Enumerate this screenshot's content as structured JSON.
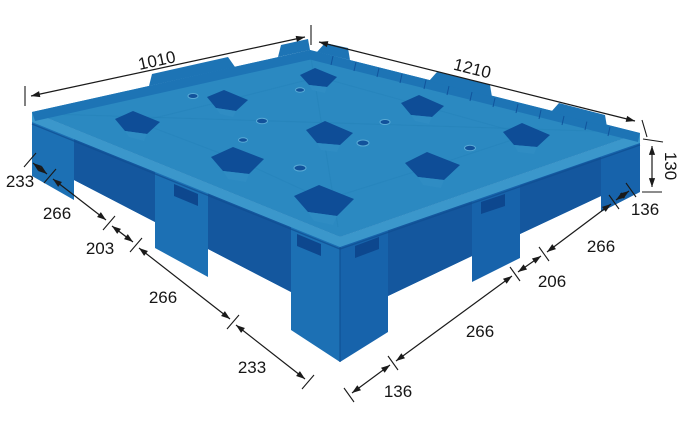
{
  "diagram": {
    "description": "Isometric dimension drawing of a blue plastic pallet on white background",
    "unit": "mm",
    "dimensions": {
      "top_left_edge": "1010",
      "top_right_edge": "1210",
      "height": "130",
      "left_chain": [
        "233",
        "266",
        "203",
        "266",
        "233"
      ],
      "right_chain": [
        "136",
        "266",
        "206",
        "266",
        "136"
      ]
    },
    "colors": {
      "background": "#ffffff",
      "ink": "#1a1a1a",
      "deck": "#2b89c1",
      "deck-seam": "#2481b7",
      "rim": "#3b97cb",
      "wall-left": "#1c70b4",
      "wall-right": "#1763ab",
      "recess": "#14579e",
      "slot": "#0d478e",
      "pocket": "#0e4d97",
      "pocket-lip": "#2f8cc3",
      "band": "#1d74b5",
      "rib": "#11549c",
      "shadow": "#0f4d92",
      "vent": "#12529b",
      "vent-ring": "#5aabd6"
    }
  }
}
